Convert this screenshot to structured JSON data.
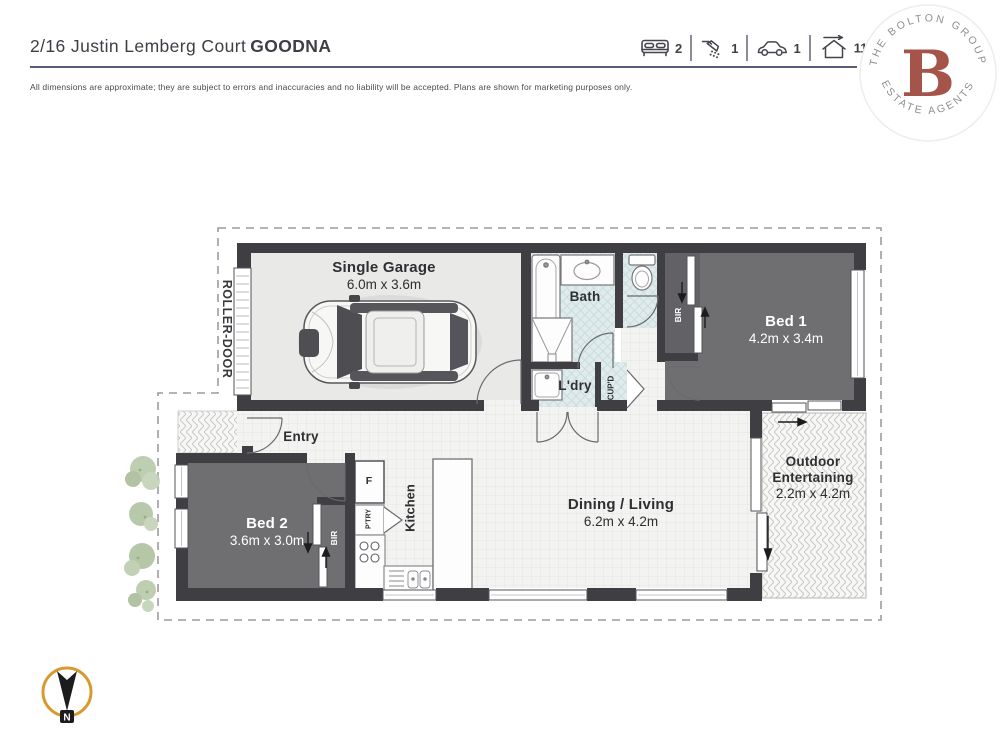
{
  "header": {
    "address": "2/16 Justin Lemberg Court",
    "suburb": "GOODNA",
    "stats": [
      {
        "icon": "bed-icon",
        "value": "2"
      },
      {
        "icon": "shower-icon",
        "value": "1"
      },
      {
        "icon": "car-icon",
        "value": "1"
      },
      {
        "icon": "house-area-icon",
        "value": "116m",
        "sup": "2"
      }
    ],
    "disclaimer": "All dimensions are approximate; they are subject to errors and inaccuracies and no liability will be accepted. Plans are shown for marketing purposes only."
  },
  "logo": {
    "arc_top": "THE BOLTON GROUP",
    "arc_bottom": "ESTATE AGENTS",
    "monogram": "B"
  },
  "floorplan": {
    "rooms": {
      "garage": {
        "name": "Single Garage",
        "dims": "6.0m x 3.6m"
      },
      "bed1": {
        "name": "Bed 1",
        "dims": "4.2m x 3.4m"
      },
      "bed2": {
        "name": "Bed 2",
        "dims": "3.6m x 3.0m"
      },
      "dining_living": {
        "name": "Dining / Living",
        "dims": "6.2m x 4.2m"
      },
      "outdoor": {
        "name": "Outdoor Entertaining",
        "dims": "2.2m x 4.2m"
      },
      "bath": {
        "name": "Bath"
      },
      "laundry": {
        "name": "L'dry"
      },
      "kitchen": {
        "name": "Kitchen"
      },
      "entry": {
        "name": "Entry"
      }
    },
    "fixtures": {
      "roller_door": "ROLLER-DOOR",
      "cupboard": "CUP'D",
      "pantry": "P'TRY",
      "fridge": "F",
      "bir_bed1": "BIR",
      "bir_bed2": "BIR"
    },
    "compass_label": "N"
  },
  "colors": {
    "accent_line": "#5a5a7a",
    "logo_monogram": "#a5544a",
    "compass_ring": "#d9992f",
    "wall": "#3f3f43"
  }
}
